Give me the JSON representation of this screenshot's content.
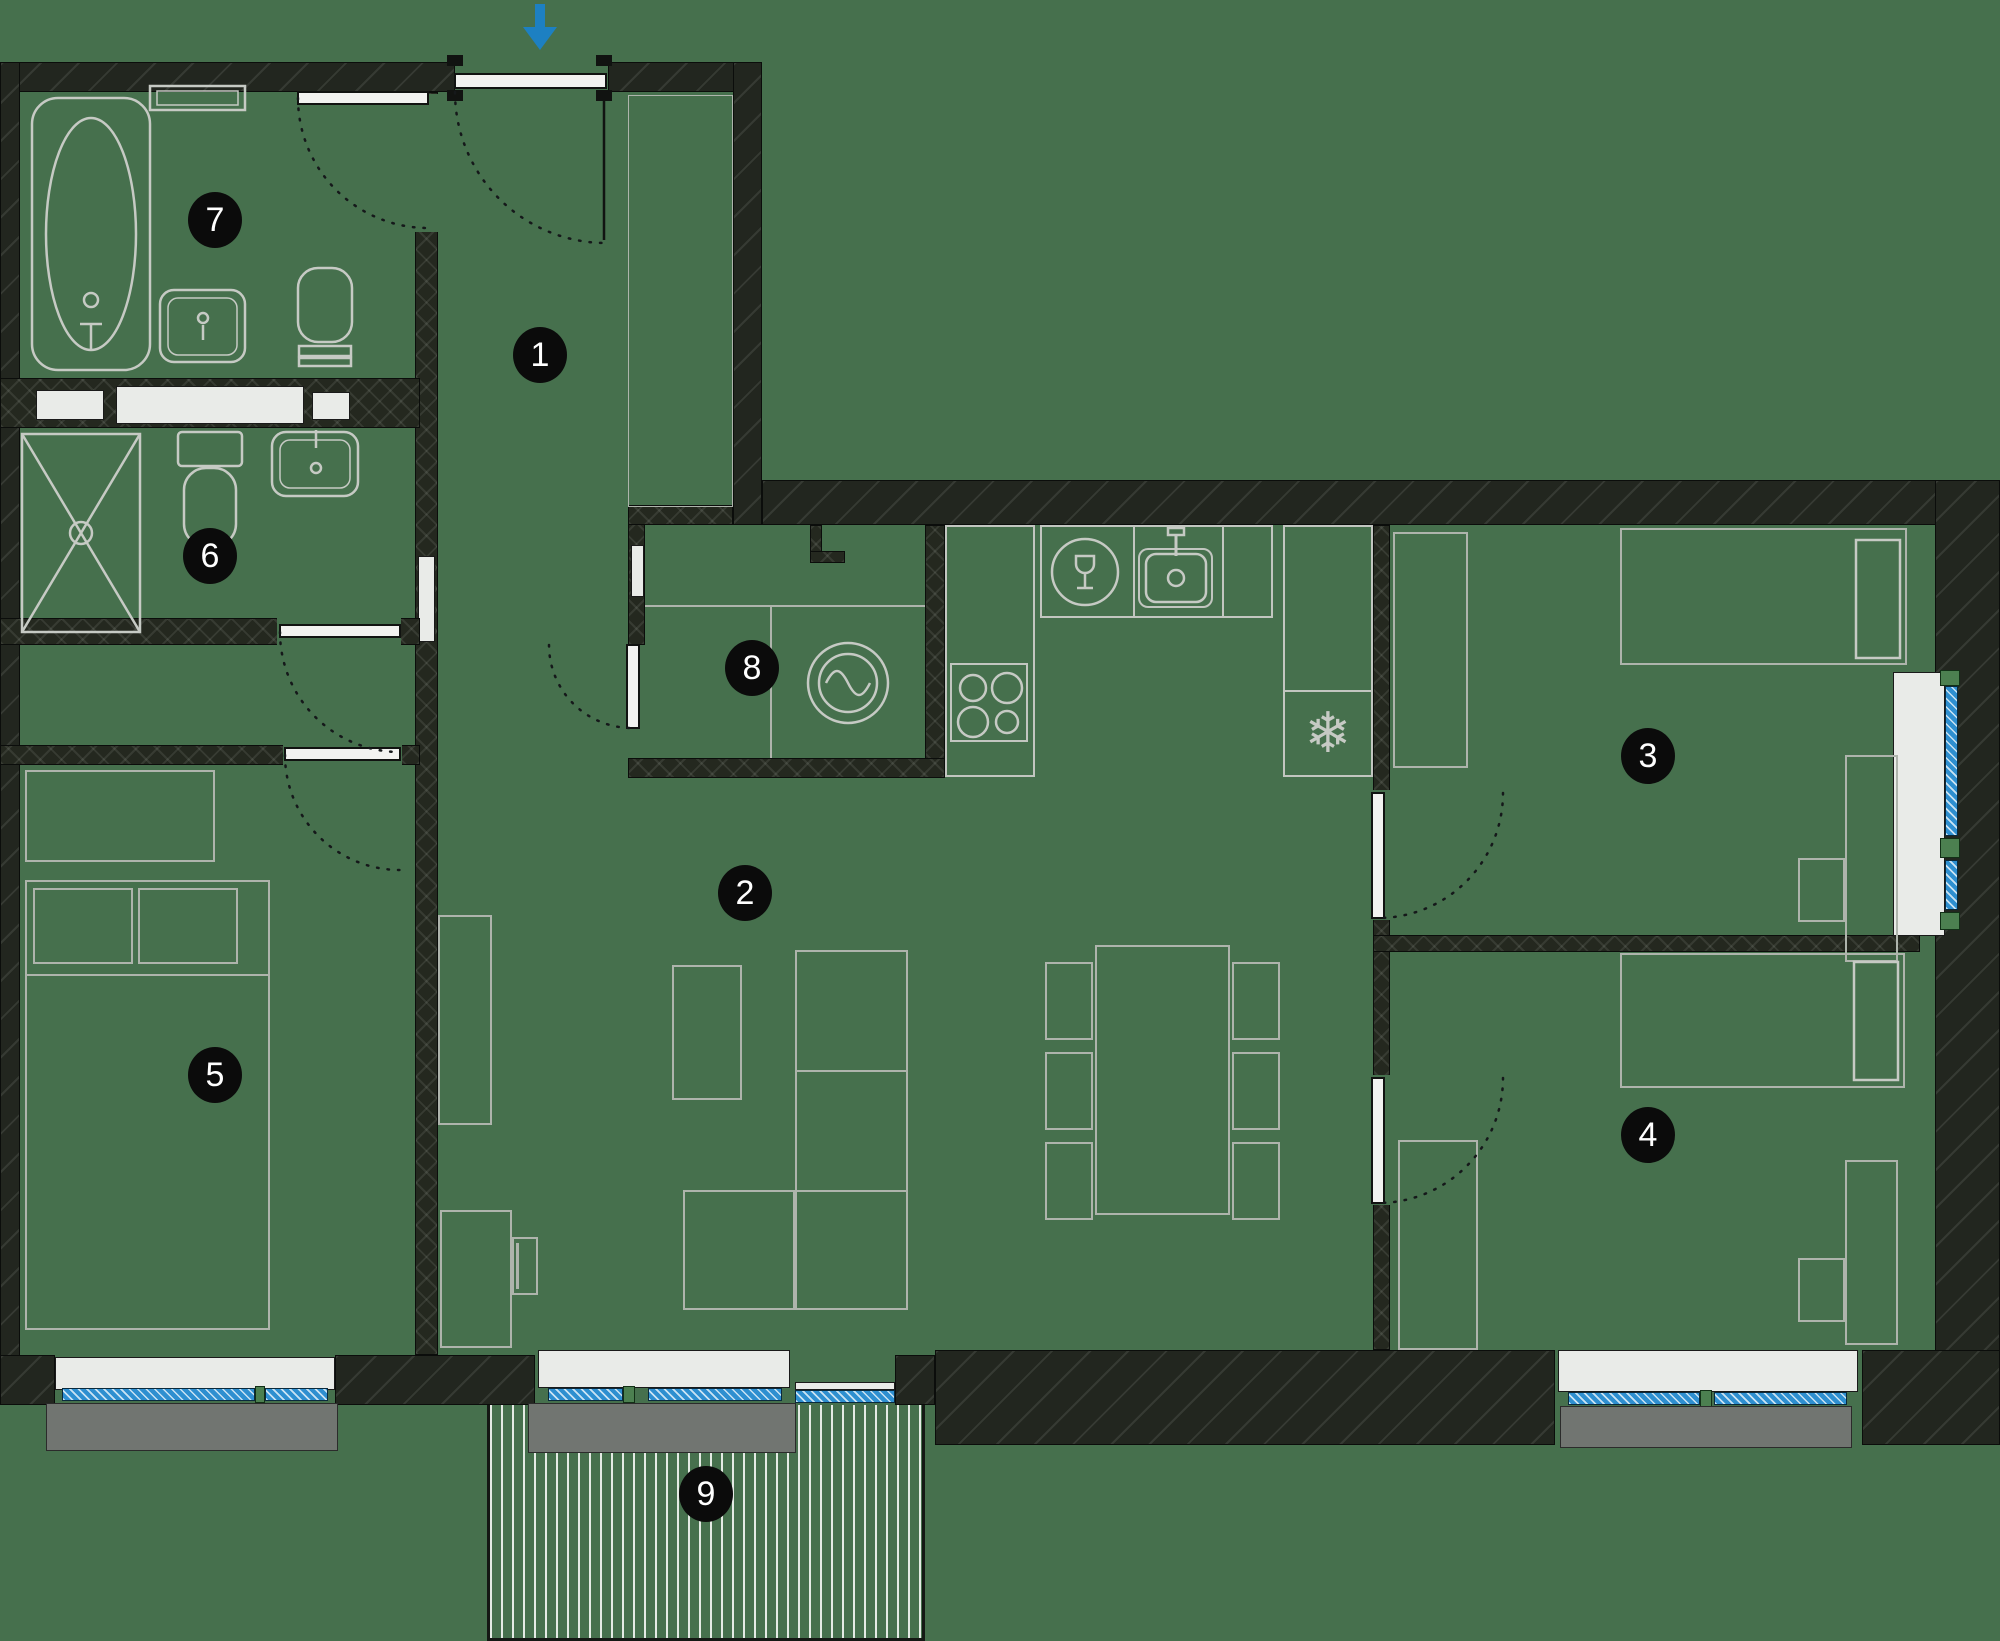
{
  "palette": {
    "background_green": "#46704d",
    "wall_dark": "#22261f",
    "partition_dark": "#24281f",
    "furniture_outline_gray": "#aeb4ac",
    "fixture_outline_gray": "#c2c6c0",
    "window_glazing_blue": "#2e8fd0",
    "window_sill_white": "#e9ebe8",
    "window_sill_gray": "#717571",
    "entrance_arrow_blue": "#1d80c2",
    "badge_black": "#0b0b0b",
    "badge_text_white": "#ffffff"
  },
  "rooms": [
    {
      "number": "1"
    },
    {
      "number": "2"
    },
    {
      "number": "3"
    },
    {
      "number": "4"
    },
    {
      "number": "5"
    },
    {
      "number": "6"
    },
    {
      "number": "7"
    },
    {
      "number": "8"
    },
    {
      "number": "9"
    }
  ],
  "icons": {
    "snowflake_glyph": "❄"
  }
}
